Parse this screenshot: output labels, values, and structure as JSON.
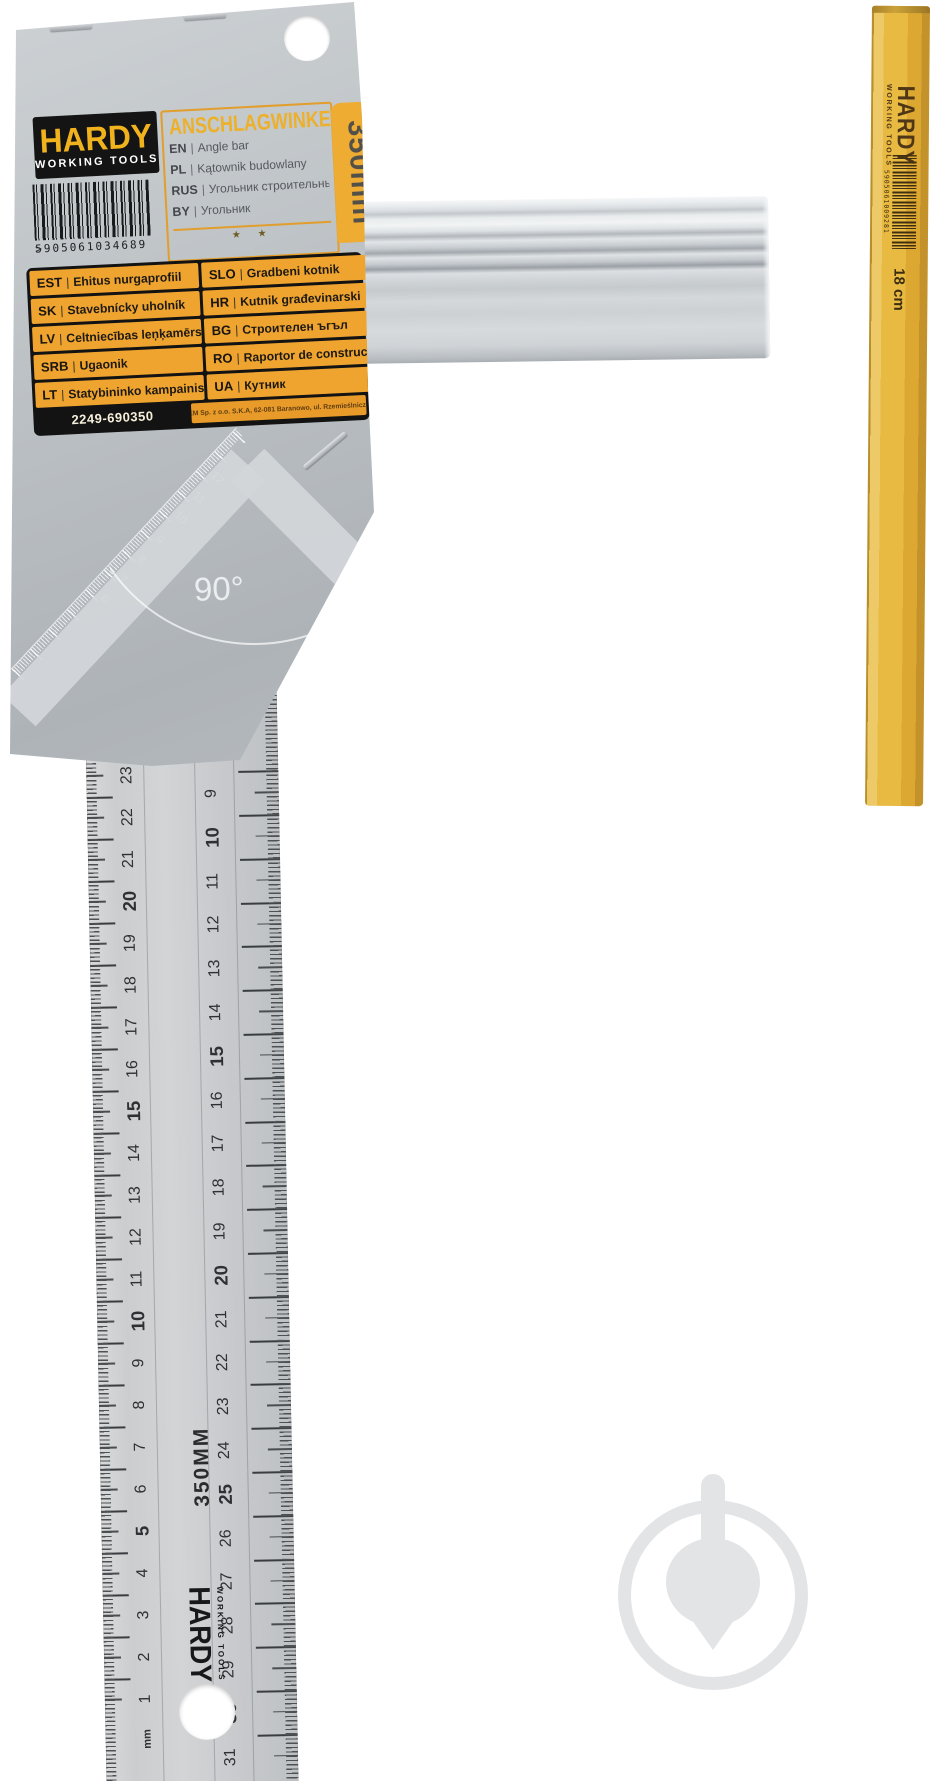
{
  "card": {
    "brand": "HARDY",
    "brand_sub": "WORKING TOOLS",
    "barcode_digits": "5905061034689",
    "barcode_suffix": ">",
    "title": "ANSCHLAGWINKEL",
    "translations": [
      {
        "code": "EN",
        "label": "Angle bar"
      },
      {
        "code": "PL",
        "label": "Kątownik budowlany"
      },
      {
        "code": "RUS",
        "label": "Угольник строительный"
      },
      {
        "code": "BY",
        "label": "Угольник"
      }
    ],
    "stars": "★ ★",
    "size_label": "350mm",
    "languages_left": [
      {
        "code": "EST",
        "label": "Ehitus nurgaprofiil"
      },
      {
        "code": "SK",
        "label": "Stavebnícky uholník"
      },
      {
        "code": "LV",
        "label": "Celtniecības leņķamērs"
      },
      {
        "code": "SRB",
        "label": "Ugaonik"
      },
      {
        "code": "LT",
        "label": "Statybininko kampainis"
      }
    ],
    "languages_right": [
      {
        "code": "SLO",
        "label": "Gradbeni kotnik"
      },
      {
        "code": "HR",
        "label": "Kutnik građevinarski"
      },
      {
        "code": "BG",
        "label": "Строителен ъгъл"
      },
      {
        "code": "RO",
        "label": "Raportor de construcții"
      },
      {
        "code": "UA",
        "label": "Кутник"
      }
    ],
    "item_code": "2249-690350",
    "manufacturer": "KAEM Sp. z o.o. S.K.A, 62-081 Baranowo, ul. Rzemieślnicza 14",
    "angle_label": "90°",
    "diag_scale_numbers": [
      "6",
      "7",
      "8",
      "9",
      "10",
      "11",
      "12"
    ]
  },
  "ruler": {
    "left_scale": [
      "23",
      "22",
      "21",
      "20",
      "19",
      "18",
      "17",
      "16",
      "15",
      "14",
      "13",
      "12",
      "11",
      "10",
      "9",
      "8",
      "7",
      "6",
      "5",
      "4",
      "3",
      "2",
      "1"
    ],
    "unit_label": "mm",
    "right_scale": [
      "9",
      "10",
      "11",
      "12",
      "13",
      "14",
      "15",
      "16",
      "17",
      "18",
      "19",
      "20",
      "21",
      "22",
      "23",
      "24",
      "25",
      "26",
      "27",
      "28",
      "29",
      "30",
      "31"
    ],
    "length_label": "350MM",
    "brand": "HARDY",
    "brand_sub": "WORKING TOOLS"
  },
  "pencil": {
    "brand": "HARDY",
    "brand_sub": "WORKING TOOLS",
    "barcode_digits": "5905061009281",
    "length_label": "18 cm"
  },
  "colors": {
    "brand_yellow": "#f0b31e",
    "label_amber": "#efa42f",
    "pencil_yellow": "#e8ba42",
    "card_gray": "#b8bdc1",
    "steel_gray": "#c8cacd"
  }
}
